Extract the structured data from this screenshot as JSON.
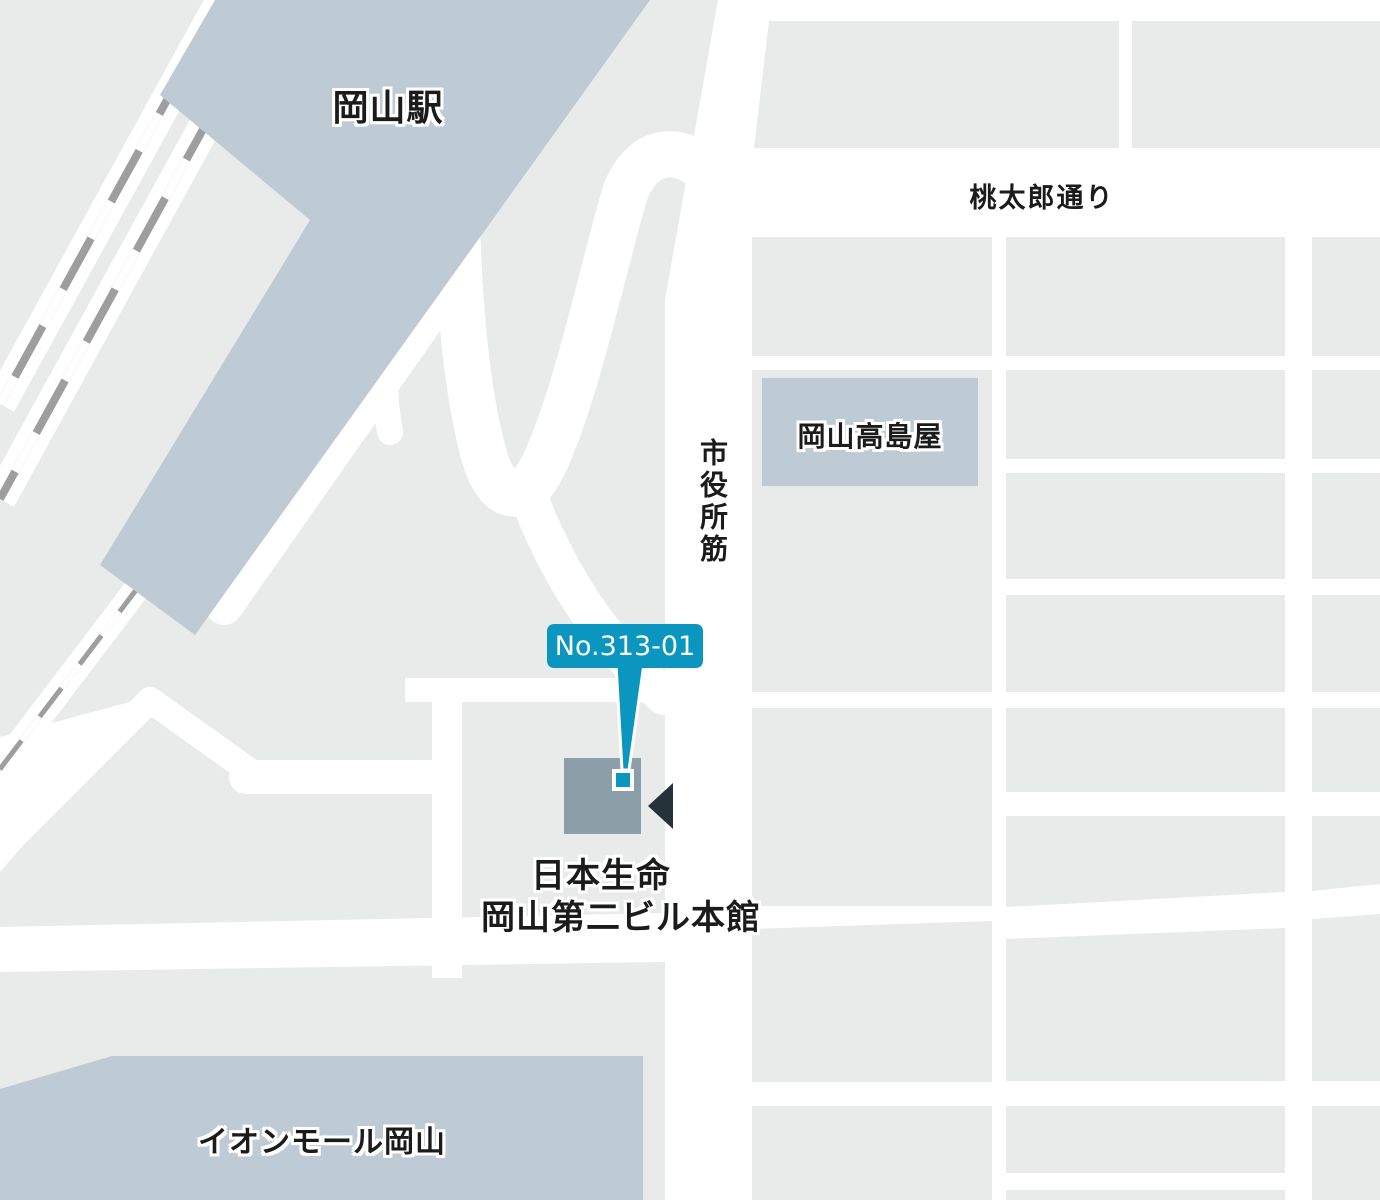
{
  "map": {
    "station": {
      "label": "岡山駅"
    },
    "roads": {
      "momotaro_street": "桃太郎通り",
      "shiyakusho_suji": "市役所筋"
    },
    "landmarks": {
      "takashimaya": "岡山高島屋",
      "aeon_mall": "イオンモール岡山"
    },
    "destination": {
      "badge": "No.313-01",
      "name_line1": "日本生命",
      "name_line2": "岡山第二ビル本館"
    },
    "colors": {
      "background": "#ffffff",
      "block_gray": "#e9eaea",
      "landmark_blue": "#bfcbd4",
      "target_building": "#8c9fa9",
      "accent_cyan": "#0b96c0",
      "track_gray": "#9e9e9e",
      "arrow_dark": "#26323a",
      "label_text": "#1b1b1b"
    }
  }
}
